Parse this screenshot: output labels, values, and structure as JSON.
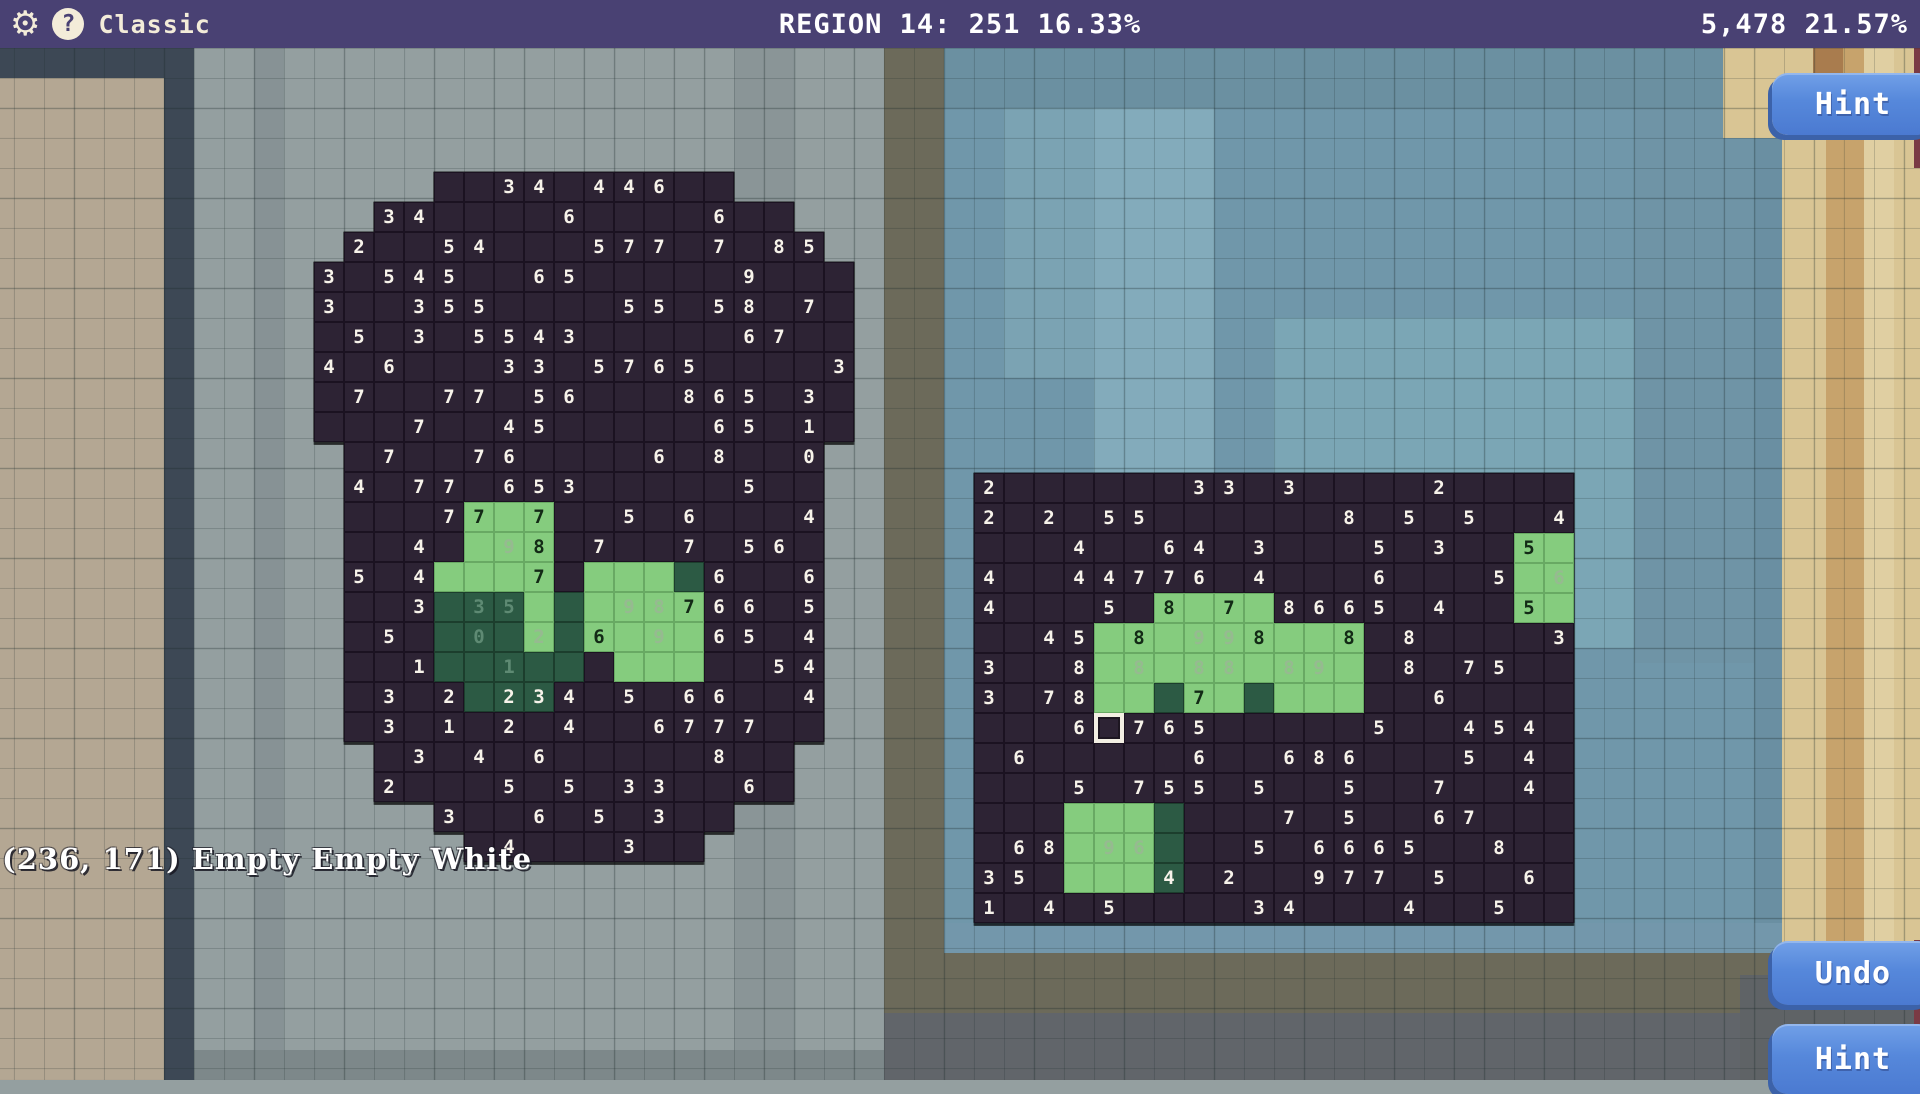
{
  "top_bar": {
    "mode_label": "Classic",
    "center_status": "REGION 14: 251 16.33%",
    "right_status": "5,478 21.57%",
    "gear_icon": "⚙",
    "help_icon": "?"
  },
  "buttons": {
    "hint_top": "Hint",
    "undo": "Undo",
    "hint_bottom": "Hint"
  },
  "status_text": "(236, 171) Empty Empty White",
  "colors": {
    "top_bar": "#494173",
    "board_cell": "#2d2334",
    "solved_light_green": "#85cc7e",
    "solved_dark_green": "#2c5a44",
    "button_blue": "#5688db",
    "background_grey": "#949fa0",
    "digit_white": "#f7f3ea",
    "digit_black": "#132a16"
  },
  "cell_legend": {
    "": "outside board",
    ".": "dark empty cell",
    "N": "dark cell with white clue N",
    "g.": "light green cell",
    "gN": "light green cell with black clue N",
    "fN": "light green cell with faded clue N",
    "d.": "dark green cell",
    "dN": "dark green cell with white clue N",
    "dfN": "dark green cell with faded clue N",
    "X": "selected cursor cell"
  },
  "left_board": {
    "cols": 18,
    "x": 314,
    "y": 172,
    "rows": [
      [
        "",
        "",
        "",
        "",
        ".",
        ".",
        "3",
        "4",
        ".",
        "4",
        "4",
        "6",
        ".",
        ".",
        "",
        "",
        "",
        ""
      ],
      [
        "",
        "",
        "3",
        "4",
        ".",
        ".",
        ".",
        ".",
        "6",
        ".",
        ".",
        ".",
        ".",
        "6",
        ".",
        ".",
        "",
        ""
      ],
      [
        "",
        "2",
        ".",
        ".",
        "5",
        "4",
        ".",
        ".",
        ".",
        "5",
        "7",
        "7",
        ".",
        "7",
        ".",
        "8",
        "5",
        ""
      ],
      [
        "3",
        ".",
        "5",
        "4",
        "5",
        ".",
        ".",
        "6",
        "5",
        ".",
        ".",
        ".",
        ".",
        ".",
        "9",
        ".",
        ".",
        "."
      ],
      [
        "3",
        ".",
        ".",
        "3",
        "5",
        "5",
        ".",
        ".",
        ".",
        ".",
        "5",
        "5",
        ".",
        "5",
        "8",
        ".",
        "7",
        "."
      ],
      [
        ".",
        "5",
        ".",
        "3",
        ".",
        "5",
        "5",
        "4",
        "3",
        ".",
        ".",
        ".",
        ".",
        ".",
        "6",
        "7",
        ".",
        "."
      ],
      [
        "4",
        ".",
        "6",
        ".",
        ".",
        ".",
        "3",
        "3",
        ".",
        "5",
        "7",
        "6",
        "5",
        ".",
        ".",
        ".",
        ".",
        "3"
      ],
      [
        ".",
        "7",
        ".",
        ".",
        "7",
        "7",
        ".",
        "5",
        "6",
        ".",
        ".",
        ".",
        "8",
        "6",
        "5",
        ".",
        "3",
        "."
      ],
      [
        ".",
        ".",
        ".",
        "7",
        ".",
        ".",
        "4",
        "5",
        ".",
        ".",
        ".",
        ".",
        ".",
        "6",
        "5",
        ".",
        "1",
        "."
      ],
      [
        "",
        ".",
        "7",
        ".",
        ".",
        "7",
        "6",
        ".",
        ".",
        ".",
        ".",
        "6",
        ".",
        "8",
        ".",
        ".",
        "0",
        ""
      ],
      [
        "",
        "4",
        ".",
        "7",
        "7",
        ".",
        "6",
        "5",
        "3",
        ".",
        ".",
        ".",
        ".",
        ".",
        "5",
        ".",
        ".",
        ""
      ],
      [
        "",
        ".",
        ".",
        ".",
        "7",
        "g7",
        "g.",
        "g7",
        ".",
        ".",
        "5",
        ".",
        "6",
        ".",
        ".",
        ".",
        "4",
        ""
      ],
      [
        "",
        ".",
        ".",
        "4",
        ".",
        "g.",
        "f9",
        "g8",
        ".",
        "7",
        ".",
        ".",
        "7",
        ".",
        "5",
        "6",
        ".",
        ""
      ],
      [
        "",
        "5",
        ".",
        "4",
        "g.",
        "g.",
        "g.",
        "g7",
        ".",
        "g.",
        "g.",
        "g.",
        "d.",
        "6",
        ".",
        ".",
        "6",
        ""
      ],
      [
        "",
        ".",
        ".",
        "3",
        "d.",
        "df3",
        "df5",
        "g.",
        "d.",
        "g.",
        "f9",
        "f8",
        "g7",
        "6",
        "6",
        ".",
        "5",
        ""
      ],
      [
        "",
        ".",
        "5",
        ".",
        "d.",
        "df0",
        "d.",
        "f2",
        "d.",
        "g6",
        "g.",
        "f9",
        "g.",
        "6",
        "5",
        ".",
        "4",
        ""
      ],
      [
        "",
        ".",
        ".",
        "1",
        "d.",
        "d.",
        "df1",
        "d.",
        "d.",
        ".",
        "g.",
        "g.",
        "g.",
        ".",
        ".",
        "5",
        "4",
        ""
      ],
      [
        "",
        ".",
        "3",
        ".",
        "2",
        "d.",
        "d2",
        "d3",
        "4",
        ".",
        "5",
        ".",
        "6",
        "6",
        ".",
        ".",
        "4",
        ""
      ],
      [
        "",
        ".",
        "3",
        ".",
        "1",
        ".",
        "2",
        ".",
        "4",
        ".",
        ".",
        "6",
        "7",
        "7",
        "7",
        ".",
        ".",
        ""
      ],
      [
        "",
        "",
        ".",
        "3",
        ".",
        "4",
        ".",
        "6",
        ".",
        ".",
        ".",
        ".",
        ".",
        "8",
        ".",
        ".",
        "",
        ""
      ],
      [
        "",
        "",
        "2",
        ".",
        ".",
        ".",
        "5",
        ".",
        "5",
        ".",
        "3",
        "3",
        ".",
        ".",
        "6",
        ".",
        "",
        ""
      ],
      [
        "",
        "",
        "",
        "",
        "3",
        ".",
        ".",
        "6",
        ".",
        "5",
        ".",
        "3",
        ".",
        ".",
        "",
        "",
        "",
        ""
      ],
      [
        "",
        "",
        "",
        "",
        "",
        ".",
        "4",
        ".",
        ".",
        ".",
        "3",
        ".",
        ".",
        "",
        "",
        "",
        "",
        ""
      ]
    ]
  },
  "right_board": {
    "cols": 20,
    "x": 974,
    "y": 473,
    "rows": [
      [
        "2",
        ".",
        ".",
        ".",
        ".",
        ".",
        ".",
        "3",
        "3",
        ".",
        "3",
        ".",
        ".",
        ".",
        ".",
        "2",
        ".",
        ".",
        ".",
        "."
      ],
      [
        "2",
        ".",
        "2",
        ".",
        "5",
        "5",
        ".",
        ".",
        ".",
        ".",
        ".",
        ".",
        "8",
        ".",
        "5",
        ".",
        "5",
        ".",
        ".",
        "4"
      ],
      [
        ".",
        ".",
        ".",
        "4",
        ".",
        ".",
        "6",
        "4",
        ".",
        "3",
        ".",
        ".",
        ".",
        "5",
        ".",
        "3",
        ".",
        ".",
        "g5",
        "g."
      ],
      [
        "4",
        ".",
        ".",
        "4",
        "4",
        "7",
        "7",
        "6",
        ".",
        "4",
        ".",
        ".",
        ".",
        "6",
        ".",
        ".",
        ".",
        "5",
        "g.",
        "f6"
      ],
      [
        "4",
        ".",
        ".",
        ".",
        "5",
        ".",
        "g8",
        "g.",
        "g7",
        "g.",
        "8",
        "6",
        "6",
        "5",
        ".",
        "4",
        ".",
        ".",
        "g5",
        "g."
      ],
      [
        ".",
        ".",
        "4",
        "5",
        "g.",
        "g8",
        "g.",
        "f9",
        "f9",
        "g8",
        "g.",
        "g.",
        "g8",
        ".",
        "8",
        ".",
        ".",
        ".",
        ".",
        "3"
      ],
      [
        "3",
        ".",
        ".",
        "8",
        "g.",
        "f8",
        "g.",
        "f8",
        "f8",
        "g.",
        "f8",
        "f9",
        "g.",
        ".",
        "8",
        ".",
        "7",
        "5",
        ".",
        "."
      ],
      [
        "3",
        ".",
        "7",
        "8",
        "g.",
        "g.",
        "d.",
        "g7",
        "g.",
        "d.",
        "g.",
        "g.",
        "g.",
        ".",
        ".",
        "6",
        ".",
        ".",
        ".",
        "."
      ],
      [
        ".",
        ".",
        ".",
        "6",
        "X",
        "7",
        "6",
        "5",
        ".",
        ".",
        ".",
        ".",
        ".",
        "5",
        ".",
        ".",
        "4",
        "5",
        "4",
        "."
      ],
      [
        ".",
        "6",
        ".",
        ".",
        ".",
        ".",
        ".",
        "6",
        ".",
        ".",
        "6",
        "8",
        "6",
        ".",
        ".",
        ".",
        "5",
        ".",
        "4",
        "."
      ],
      [
        ".",
        ".",
        ".",
        "5",
        ".",
        "7",
        "5",
        "5",
        ".",
        "5",
        ".",
        ".",
        "5",
        ".",
        ".",
        "7",
        ".",
        ".",
        "4",
        "."
      ],
      [
        ".",
        ".",
        ".",
        "g.",
        "g.",
        "g.",
        "d.",
        ".",
        ".",
        ".",
        "7",
        ".",
        "5",
        ".",
        ".",
        "6",
        "7",
        ".",
        ".",
        "."
      ],
      [
        ".",
        "6",
        "8",
        "g.",
        "f9",
        "f6",
        "d.",
        ".",
        ".",
        "5",
        ".",
        "6",
        "6",
        "6",
        "5",
        ".",
        ".",
        "8",
        ".",
        "."
      ],
      [
        "3",
        "5",
        ".",
        "g.",
        "g.",
        "g.",
        "d4",
        ".",
        "2",
        ".",
        ".",
        "9",
        "7",
        "7",
        ".",
        "5",
        ".",
        ".",
        "6",
        "."
      ],
      [
        "1",
        ".",
        "4",
        ".",
        "5",
        ".",
        ".",
        ".",
        ".",
        "3",
        "4",
        ".",
        ".",
        ".",
        "4",
        ".",
        ".",
        "5",
        ".",
        "."
      ]
    ]
  },
  "background_map": {
    "bands": [
      {
        "x": 944,
        "y": 48,
        "w": 838,
        "h": 1032,
        "c": "#7097aa"
      },
      {
        "x": 1004,
        "y": 48,
        "w": 90,
        "h": 330,
        "c": "#7ba3b3"
      },
      {
        "x": 1094,
        "y": 48,
        "w": 120,
        "h": 570,
        "c": "#83abbb"
      },
      {
        "x": 1274,
        "y": 318,
        "w": 480,
        "h": 330,
        "c": "#7ba6b5"
      },
      {
        "x": 944,
        "y": 48,
        "w": 838,
        "h": 60,
        "c": "#6b90a1"
      },
      {
        "x": 1634,
        "y": 108,
        "w": 120,
        "h": 555,
        "c": "#6f94a6"
      },
      {
        "x": 1754,
        "y": 48,
        "w": 28,
        "h": 1032,
        "c": "#6a8fa2"
      },
      {
        "x": 1782,
        "y": 48,
        "w": 138,
        "h": 1032,
        "c": "#d9c594"
      },
      {
        "x": 1826,
        "y": 48,
        "w": 38,
        "h": 1032,
        "c": "#c7a36c"
      },
      {
        "x": 1864,
        "y": 48,
        "w": 30,
        "h": 1032,
        "c": "#e0cfa2"
      },
      {
        "x": 1723,
        "y": 48,
        "w": 60,
        "h": 90,
        "c": "#d9c594"
      },
      {
        "x": 1813,
        "y": 48,
        "w": 30,
        "h": 60,
        "c": "#a97c4e"
      },
      {
        "x": 1914,
        "y": 48,
        "w": 6,
        "h": 120,
        "c": "#7a3a44"
      },
      {
        "x": 0,
        "y": 48,
        "w": 194,
        "h": 30,
        "c": "#3d4855"
      },
      {
        "x": 0,
        "y": 78,
        "w": 164,
        "h": 1002,
        "c": "#b4a793"
      },
      {
        "x": 164,
        "y": 48,
        "w": 30,
        "h": 1032,
        "c": "#3d4855"
      },
      {
        "x": 254,
        "y": 48,
        "w": 30,
        "h": 1032,
        "c": "#879295"
      },
      {
        "x": 734,
        "y": 48,
        "w": 60,
        "h": 1032,
        "c": "#8a9597"
      },
      {
        "x": 884,
        "y": 48,
        "w": 60,
        "h": 1032,
        "c": "#6c6a5a"
      },
      {
        "x": 944,
        "y": 923,
        "w": 838,
        "h": 30,
        "c": "#7397ab"
      },
      {
        "x": 884,
        "y": 953,
        "w": 898,
        "h": 60,
        "c": "#6c6a5a"
      },
      {
        "x": 884,
        "y": 1013,
        "w": 1036,
        "h": 67,
        "c": "#61656a"
      },
      {
        "x": 1740,
        "y": 975,
        "w": 180,
        "h": 105,
        "c": "#5f6366"
      },
      {
        "x": 1914,
        "y": 940,
        "w": 6,
        "h": 140,
        "c": "#7a3a44"
      },
      {
        "x": 194,
        "y": 1050,
        "w": 690,
        "h": 30,
        "c": "#7d888a"
      }
    ]
  }
}
